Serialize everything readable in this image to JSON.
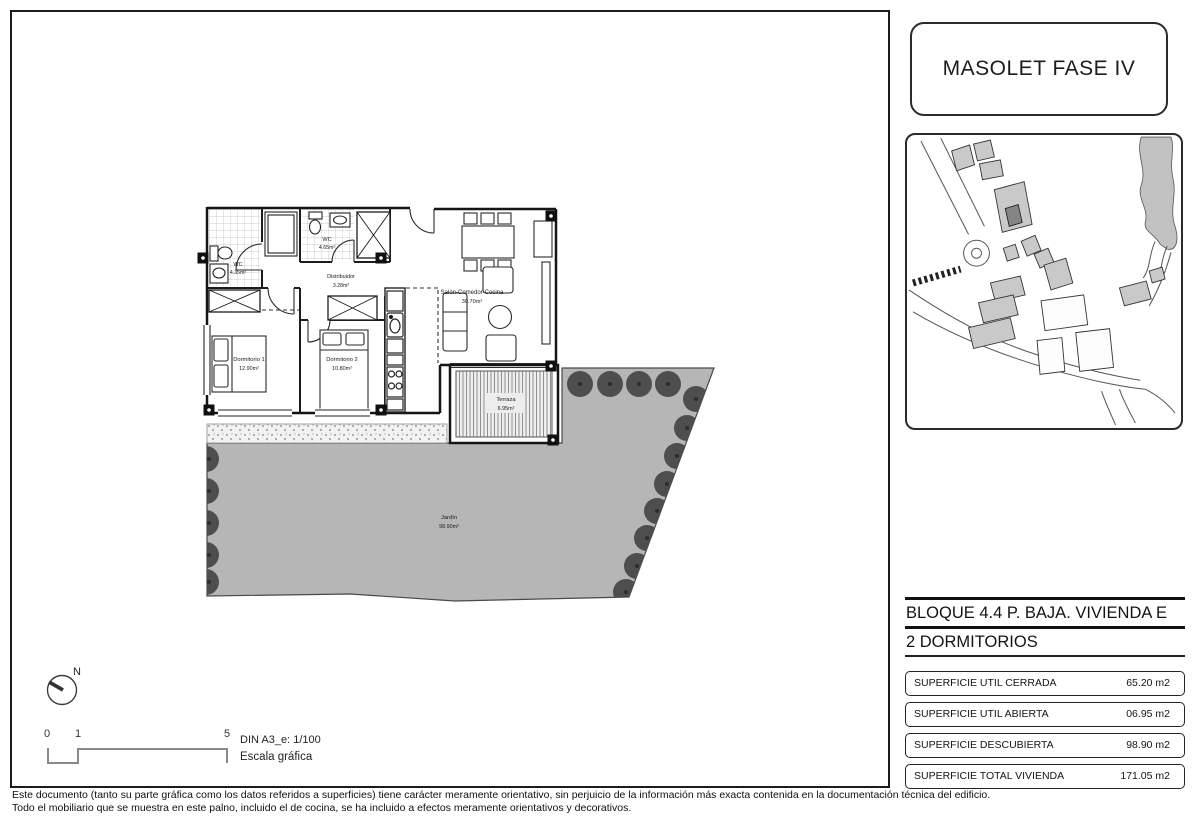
{
  "title_box": {
    "title": "MASOLET FASE IV"
  },
  "plan": {
    "rooms": [
      {
        "label": "WC",
        "area": "4.35m²"
      },
      {
        "label": "WC",
        "area": "4.65m²"
      },
      {
        "label": "Distribuidor",
        "area": "3.28m²"
      },
      {
        "label": "Dormitorio 1",
        "area": "12.90m²"
      },
      {
        "label": "Dormitorio 2",
        "area": "10.80m²"
      },
      {
        "label": "Salón-Comedor-Cocina",
        "area": "30.70m²"
      },
      {
        "label": "Terraza",
        "area": "6.95m²"
      },
      {
        "label": "Jardín",
        "area": "98.90m²"
      }
    ]
  },
  "info_panel": {
    "block_title": "BLOQUE 4.4 P. BAJA. VIVIENDA E",
    "type_title": "2 DORMITORIOS",
    "surfaces": [
      {
        "label": "SUPERFICIE UTIL CERRADA",
        "value": "65.20 m2"
      },
      {
        "label": "SUPERFICIE UTIL ABIERTA",
        "value": "06.95 m2"
      },
      {
        "label": "SUPERFICIE DESCUBIERTA",
        "value": "98.90 m2"
      },
      {
        "label": "SUPERFICIE TOTAL VIVIENDA",
        "value": "171.05 m2"
      }
    ]
  },
  "scale_block": {
    "north_label": "N",
    "tick_0": "0",
    "tick_1": "1",
    "tick_5": "5",
    "din_label": "DIN A3_e: 1/100",
    "caption": "Escala gráfica"
  },
  "footer": {
    "line1": "Este documento (tanto su parte gráfica como los datos referidos a superficies) tiene carácter meramente orientativo, sin perjuicio de la información más exacta contenida en la documentación técnica del edificio.",
    "line2": "Todo el mobiliario que se muestra en este palno, incluido el de cocina, se ha incluido a efectos meramente orientativos y decorativos."
  },
  "colors": {
    "garden": "#b6b6b6",
    "tree": "#4e4e4e",
    "building_light": "#c9c9c9",
    "building_highlight": "#858585",
    "line": "#1b1b1b"
  }
}
